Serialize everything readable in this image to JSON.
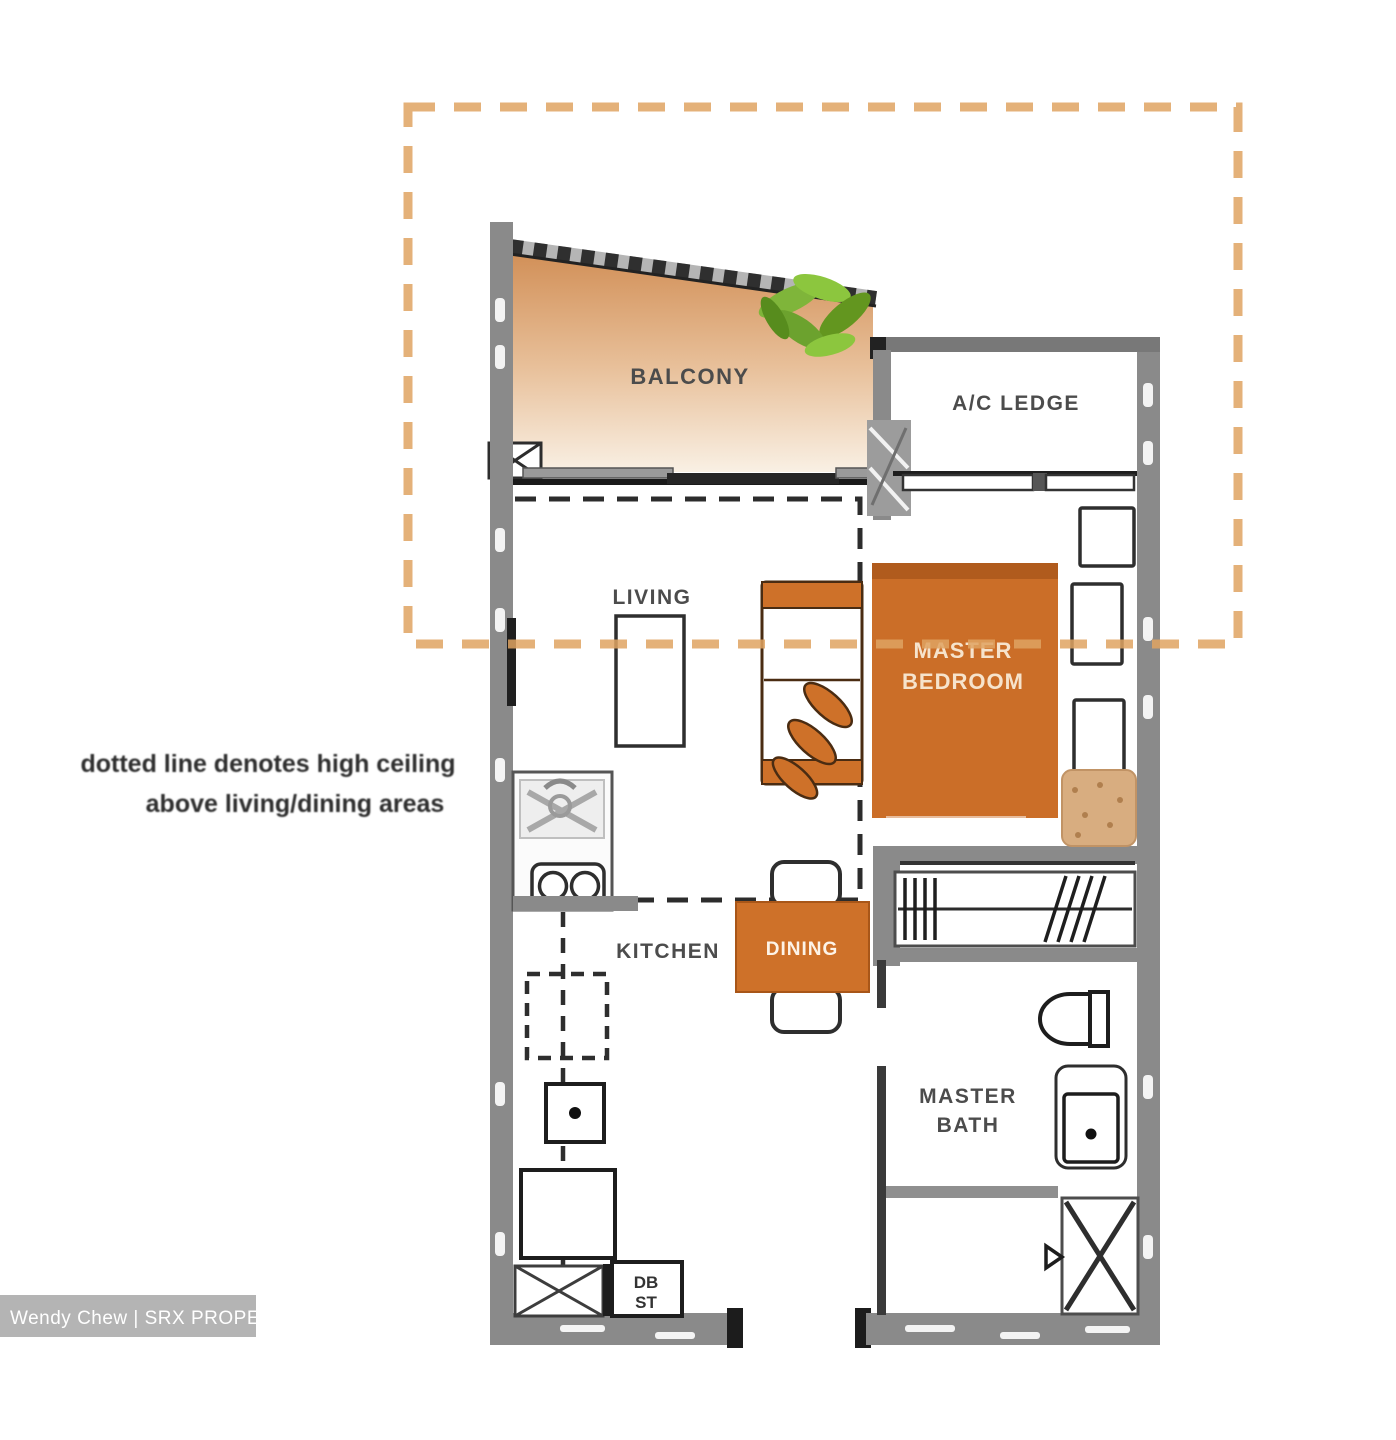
{
  "rooms": {
    "balcony": "BALCONY",
    "ac_ledge": "A/C LEDGE",
    "living": "LIVING",
    "master_bedroom_l1": "MASTER",
    "master_bedroom_l2": "BEDROOM",
    "kitchen": "KITCHEN",
    "dining": "DINING",
    "master_bath_l1": "MASTER",
    "master_bath_l2": "BATH"
  },
  "labels": {
    "db": "DB",
    "st": "ST"
  },
  "note": {
    "line1": "dotted line denotes high ceiling",
    "line2": "above living/dining areas"
  },
  "watermark": {
    "text": "Wendy Chew | SRX PROPERTY"
  },
  "colors": {
    "accent_orange": "#ce7129",
    "dashed_boundary_orange": "#dfa362",
    "wall_gray": "#8a8a8a",
    "plant_green": "#7fb53a",
    "balcony_gradient_top": "#cf8a50",
    "balcony_gradient_bottom": "#f9f0e4",
    "watermark_bar": "#b4b4b4"
  }
}
